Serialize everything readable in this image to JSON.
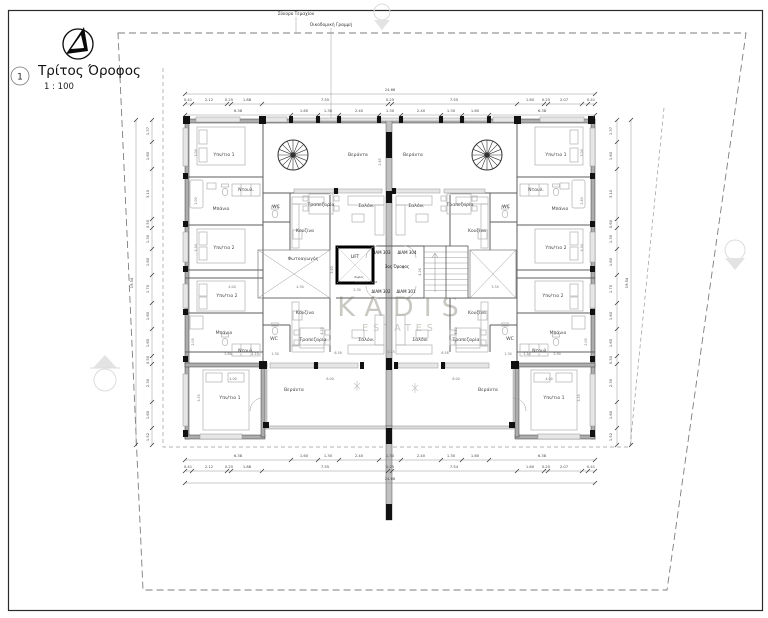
{
  "title": {
    "number": "1",
    "name": "Τρίτος Όροφος",
    "scale": "1 : 100"
  },
  "annotations": {
    "plot_boundary": "Σύνορο Τεμαχίου",
    "building_line": "Οικοδομική Γραμμή"
  },
  "watermark": {
    "brand": "KADIS",
    "sub": "ESTATES"
  },
  "core": {
    "lift": "LIFT",
    "floor": "3ος Όροφος",
    "amea_line1": "Χώρος",
    "amea_line2": "αναμονής ΑΜΕΑ",
    "apt_303": "ΔΙΑΜ 303",
    "apt_304": "ΔΙΑΜ 304",
    "apt_302": "ΔΙΑΜ 302",
    "apt_301": "ΔΙΑΜ 301"
  },
  "overall_dimensions": {
    "width_m": "24.66",
    "height_m": "19.54"
  },
  "colors": {
    "wall_gray": "#adadad",
    "wall_black": "#111111",
    "dim_text": "#787878",
    "boundary_dash": "#7d7d7d",
    "watermark": "rgba(150,145,133,0.5)"
  },
  "labels": [
    {
      "t": "Υπν/τιο 1",
      "x": 224,
      "y": 156
    },
    {
      "t": "Ντουλ.",
      "x": 246,
      "y": 191
    },
    {
      "t": "Μπάνιο",
      "x": 221,
      "y": 210
    },
    {
      "t": "Υπν/τιο 2",
      "x": 224,
      "y": 249
    },
    {
      "t": "WC",
      "x": 276,
      "y": 208
    },
    {
      "t": "Κουζίνα",
      "x": 305,
      "y": 232
    },
    {
      "t": "Τραπεζαρία",
      "x": 321,
      "y": 206
    },
    {
      "t": "Σαλόνι",
      "x": 366,
      "y": 207
    },
    {
      "t": "Βεράντα",
      "x": 358,
      "y": 156
    },
    {
      "t": "Φωτοαγωγός",
      "x": 303,
      "y": 260
    },
    {
      "t": "Βεράντα",
      "x": 413,
      "y": 156
    },
    {
      "t": "Σαλόνι",
      "x": 416,
      "y": 207
    },
    {
      "t": "Τραπεζαρία",
      "x": 460,
      "y": 206
    },
    {
      "t": "Κουζίνα",
      "x": 477,
      "y": 232
    },
    {
      "t": "WC",
      "x": 506,
      "y": 208
    },
    {
      "t": "Ντουλ.",
      "x": 536,
      "y": 191
    },
    {
      "t": "Μπάνιο",
      "x": 560,
      "y": 210
    },
    {
      "t": "Υπν/τιο 1",
      "x": 556,
      "y": 156
    },
    {
      "t": "Υπν/τιο 2",
      "x": 556,
      "y": 249
    },
    {
      "t": "Υπν/τιο 2",
      "x": 227,
      "y": 297
    },
    {
      "t": "Μπάνιο",
      "x": 224,
      "y": 334
    },
    {
      "t": "Ντουλ.",
      "x": 246,
      "y": 352
    },
    {
      "t": "WC",
      "x": 274,
      "y": 340
    },
    {
      "t": "Κουζίνα",
      "x": 305,
      "y": 314
    },
    {
      "t": "Τραπεζαρία",
      "x": 313,
      "y": 341
    },
    {
      "t": "Σαλόνι",
      "x": 366,
      "y": 341
    },
    {
      "t": "Βεράντα",
      "x": 294,
      "y": 391
    },
    {
      "t": "Υπν/τιο 1",
      "x": 230,
      "y": 399
    },
    {
      "t": "Σαλόνι",
      "x": 420,
      "y": 341
    },
    {
      "t": "Τραπεζαρία",
      "x": 466,
      "y": 341
    },
    {
      "t": "Κουζίνα",
      "x": 477,
      "y": 314
    },
    {
      "t": "WC",
      "x": 510,
      "y": 340
    },
    {
      "t": "Ντουλ.",
      "x": 540,
      "y": 352
    },
    {
      "t": "Μπάνιο",
      "x": 558,
      "y": 334
    },
    {
      "t": "Υπν/τιο 2",
      "x": 553,
      "y": 297
    },
    {
      "t": "Βεράντα",
      "x": 488,
      "y": 391
    },
    {
      "t": "Υπν/τιο 1",
      "x": 554,
      "y": 399
    },
    {
      "t": "24.66",
      "x": 390,
      "y": 91,
      "k": "dim"
    },
    {
      "t": "0.41",
      "x": 188,
      "y": 101,
      "k": "dim"
    },
    {
      "t": "2.12",
      "x": 209,
      "y": 101,
      "k": "dim"
    },
    {
      "t": "0.25",
      "x": 229,
      "y": 101,
      "k": "dim"
    },
    {
      "t": "1.88",
      "x": 247,
      "y": 101,
      "k": "dim"
    },
    {
      "t": "7.55",
      "x": 325,
      "y": 101,
      "k": "dim"
    },
    {
      "t": "0.25",
      "x": 390,
      "y": 101,
      "k": "dim"
    },
    {
      "t": "7.55",
      "x": 454,
      "y": 101,
      "k": "dim"
    },
    {
      "t": "1.60",
      "x": 530,
      "y": 101,
      "k": "dim"
    },
    {
      "t": "0.25",
      "x": 546,
      "y": 101,
      "k": "dim"
    },
    {
      "t": "2.07",
      "x": 564,
      "y": 101,
      "k": "dim"
    },
    {
      "t": "0.41",
      "x": 591,
      "y": 101,
      "k": "dim"
    },
    {
      "t": "6.38",
      "x": 238,
      "y": 112,
      "k": "dim"
    },
    {
      "t": "1.60",
      "x": 304,
      "y": 112,
      "k": "dim"
    },
    {
      "t": "1.30",
      "x": 328,
      "y": 112,
      "k": "dim"
    },
    {
      "t": "2.40",
      "x": 359,
      "y": 112,
      "k": "dim"
    },
    {
      "t": "1.30",
      "x": 390,
      "y": 112,
      "k": "dim"
    },
    {
      "t": "2.40",
      "x": 421,
      "y": 112,
      "k": "dim"
    },
    {
      "t": "1.30",
      "x": 451,
      "y": 112,
      "k": "dim"
    },
    {
      "t": "1.60",
      "x": 475,
      "y": 112,
      "k": "dim"
    },
    {
      "t": "6.38",
      "x": 542,
      "y": 112,
      "k": "dim"
    },
    {
      "t": "6.38",
      "x": 238,
      "y": 457,
      "k": "dim"
    },
    {
      "t": "1.60",
      "x": 304,
      "y": 457,
      "k": "dim"
    },
    {
      "t": "1.30",
      "x": 328,
      "y": 457,
      "k": "dim"
    },
    {
      "t": "2.40",
      "x": 359,
      "y": 457,
      "k": "dim"
    },
    {
      "t": "1.30",
      "x": 390,
      "y": 457,
      "k": "dim"
    },
    {
      "t": "2.40",
      "x": 421,
      "y": 457,
      "k": "dim"
    },
    {
      "t": "1.30",
      "x": 451,
      "y": 457,
      "k": "dim"
    },
    {
      "t": "1.60",
      "x": 475,
      "y": 457,
      "k": "dim"
    },
    {
      "t": "6.38",
      "x": 542,
      "y": 457,
      "k": "dim"
    },
    {
      "t": "0.41",
      "x": 188,
      "y": 468,
      "k": "dim"
    },
    {
      "t": "2.12",
      "x": 209,
      "y": 468,
      "k": "dim"
    },
    {
      "t": "0.25",
      "x": 229,
      "y": 468,
      "k": "dim"
    },
    {
      "t": "1.88",
      "x": 247,
      "y": 468,
      "k": "dim"
    },
    {
      "t": "7.55",
      "x": 325,
      "y": 468,
      "k": "dim"
    },
    {
      "t": "0.25",
      "x": 390,
      "y": 468,
      "k": "dim"
    },
    {
      "t": "7.54",
      "x": 454,
      "y": 468,
      "k": "dim"
    },
    {
      "t": "1.60",
      "x": 530,
      "y": 468,
      "k": "dim"
    },
    {
      "t": "0.25",
      "x": 546,
      "y": 468,
      "k": "dim"
    },
    {
      "t": "2.07",
      "x": 564,
      "y": 468,
      "k": "dim"
    },
    {
      "t": "0.41",
      "x": 591,
      "y": 468,
      "k": "dim"
    },
    {
      "t": "24.66",
      "x": 390,
      "y": 480,
      "k": "dim"
    },
    {
      "t": "19.54",
      "x": 133,
      "y": 283,
      "k": "dim",
      "r": -90
    },
    {
      "t": "1.37",
      "x": 149,
      "y": 131,
      "k": "dim",
      "r": -90
    },
    {
      "t": "1.60",
      "x": 149,
      "y": 156,
      "k": "dim",
      "r": -90
    },
    {
      "t": "3.10",
      "x": 149,
      "y": 194,
      "k": "dim",
      "r": -90
    },
    {
      "t": "0.50",
      "x": 149,
      "y": 224,
      "k": "dim",
      "r": -90
    },
    {
      "t": "1.30",
      "x": 149,
      "y": 239,
      "k": "dim",
      "r": -90
    },
    {
      "t": "1.60",
      "x": 149,
      "y": 262,
      "k": "dim",
      "r": -90
    },
    {
      "t": "1.70",
      "x": 149,
      "y": 289,
      "k": "dim",
      "r": -90
    },
    {
      "t": "1.60",
      "x": 149,
      "y": 316,
      "k": "dim",
      "r": -90
    },
    {
      "t": "1.65",
      "x": 149,
      "y": 343,
      "k": "dim",
      "r": -90
    },
    {
      "t": "0.50",
      "x": 149,
      "y": 360,
      "k": "dim",
      "r": -90
    },
    {
      "t": "2.30",
      "x": 149,
      "y": 383,
      "k": "dim",
      "r": -90
    },
    {
      "t": "1.60",
      "x": 149,
      "y": 415,
      "k": "dim",
      "r": -90
    },
    {
      "t": "1.52",
      "x": 149,
      "y": 437,
      "k": "dim",
      "r": -90
    },
    {
      "t": "19.54",
      "x": 628,
      "y": 283,
      "k": "dim",
      "r": -90
    },
    {
      "t": "1.37",
      "x": 612,
      "y": 131,
      "k": "dim",
      "r": -90
    },
    {
      "t": "1.60",
      "x": 612,
      "y": 156,
      "k": "dim",
      "r": -90
    },
    {
      "t": "3.10",
      "x": 612,
      "y": 194,
      "k": "dim",
      "r": -90
    },
    {
      "t": "0.60",
      "x": 612,
      "y": 224,
      "k": "dim",
      "r": -90
    },
    {
      "t": "1.30",
      "x": 612,
      "y": 239,
      "k": "dim",
      "r": -90
    },
    {
      "t": "1.60",
      "x": 612,
      "y": 262,
      "k": "dim",
      "r": -90
    },
    {
      "t": "1.70",
      "x": 612,
      "y": 289,
      "k": "dim",
      "r": -90
    },
    {
      "t": "1.60",
      "x": 612,
      "y": 316,
      "k": "dim",
      "r": -90
    },
    {
      "t": "1.65",
      "x": 612,
      "y": 343,
      "k": "dim",
      "r": -90
    },
    {
      "t": "0.50",
      "x": 612,
      "y": 360,
      "k": "dim",
      "r": -90
    },
    {
      "t": "2.30",
      "x": 612,
      "y": 383,
      "k": "dim",
      "r": -90
    },
    {
      "t": "1.60",
      "x": 612,
      "y": 415,
      "k": "dim",
      "r": -90
    },
    {
      "t": "1.52",
      "x": 612,
      "y": 437,
      "k": "dim",
      "r": -90
    },
    {
      "t": "3.00",
      "x": 197,
      "y": 153,
      "k": "dims",
      "r": -90
    },
    {
      "t": "2.00",
      "x": 197,
      "y": 201,
      "k": "dims",
      "r": -90
    },
    {
      "t": "3.30",
      "x": 197,
      "y": 248,
      "k": "dims",
      "r": -90
    },
    {
      "t": "3.00",
      "x": 583,
      "y": 153,
      "k": "dims",
      "r": -90
    },
    {
      "t": "2.40",
      "x": 583,
      "y": 201,
      "k": "dims",
      "r": -90
    },
    {
      "t": "3.30",
      "x": 583,
      "y": 248,
      "k": "dims",
      "r": -90
    },
    {
      "t": "2.85",
      "x": 381,
      "y": 162,
      "k": "dims",
      "r": -90
    },
    {
      "t": "4.30",
      "x": 300,
      "y": 288,
      "k": "dims"
    },
    {
      "t": "3.40",
      "x": 333,
      "y": 270,
      "k": "dims",
      "r": -90
    },
    {
      "t": "3.34",
      "x": 495,
      "y": 288,
      "k": "dims"
    },
    {
      "t": "4.26",
      "x": 421,
      "y": 272,
      "k": "dims",
      "r": -90
    },
    {
      "t": "2.30",
      "x": 357,
      "y": 291,
      "k": "dims"
    },
    {
      "t": "4.00",
      "x": 232,
      "y": 288,
      "k": "dims"
    },
    {
      "t": "2.05",
      "x": 194,
      "y": 342,
      "k": "dims",
      "r": -90
    },
    {
      "t": "2.80",
      "x": 228,
      "y": 355,
      "k": "dims"
    },
    {
      "t": "1.10",
      "x": 255,
      "y": 355,
      "k": "dims"
    },
    {
      "t": "1.30",
      "x": 275,
      "y": 355,
      "k": "dims"
    },
    {
      "t": "4.20",
      "x": 323,
      "y": 331,
      "k": "dims",
      "r": -90
    },
    {
      "t": "4.20",
      "x": 457,
      "y": 331,
      "k": "dims",
      "r": -90
    },
    {
      "t": "6.58",
      "x": 338,
      "y": 354,
      "k": "dims"
    },
    {
      "t": "0.25",
      "x": 391,
      "y": 353,
      "k": "dims"
    },
    {
      "t": "6.58",
      "x": 445,
      "y": 354,
      "k": "dims"
    },
    {
      "t": "8.00",
      "x": 330,
      "y": 380,
      "k": "dims"
    },
    {
      "t": "8.00",
      "x": 456,
      "y": 380,
      "k": "dims"
    },
    {
      "t": "4.00",
      "x": 233,
      "y": 380,
      "k": "dims"
    },
    {
      "t": "3.55",
      "x": 200,
      "y": 398,
      "k": "dims",
      "r": -90
    },
    {
      "t": "4.00",
      "x": 549,
      "y": 380,
      "k": "dims"
    },
    {
      "t": "3.55",
      "x": 580,
      "y": 398,
      "k": "dims",
      "r": -90
    },
    {
      "t": "1.30",
      "x": 508,
      "y": 355,
      "k": "dims"
    },
    {
      "t": "1.10",
      "x": 527,
      "y": 355,
      "k": "dims"
    },
    {
      "t": "2.90",
      "x": 557,
      "y": 355,
      "k": "dims"
    },
    {
      "t": "2.05",
      "x": 587,
      "y": 342,
      "k": "dims",
      "r": -90
    }
  ]
}
